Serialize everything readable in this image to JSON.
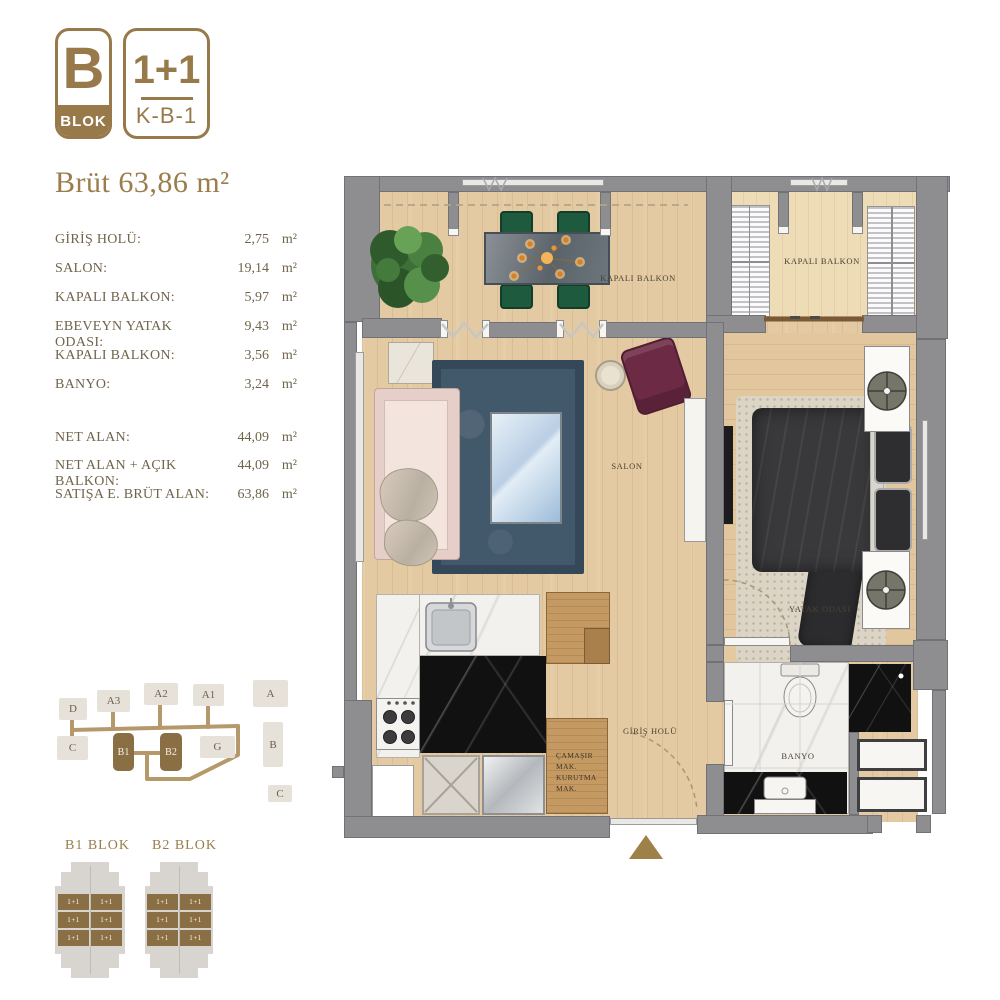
{
  "header": {
    "block_letter": "B",
    "block_word": "BLOK",
    "unit_type": "1+1",
    "unit_code": "K-B-1",
    "title": "Brüt 63,86 m²"
  },
  "area_table": {
    "rows": [
      {
        "label": "GİRİŞ HOLÜ:",
        "value": "2,75",
        "unit": "m²"
      },
      {
        "label": "SALON:",
        "value": "19,14",
        "unit": "m²"
      },
      {
        "label": "KAPALI BALKON:",
        "value": "5,97",
        "unit": "m²"
      },
      {
        "label": "EBEVEYN YATAK ODASI:",
        "value": "9,43",
        "unit": "m²"
      },
      {
        "label": "KAPALI BALKON:",
        "value": "3,56",
        "unit": "m²"
      },
      {
        "label": "BANYO:",
        "value": "3,24",
        "unit": "m²"
      }
    ],
    "totals": [
      {
        "label": "NET ALAN:",
        "value": "44,09",
        "unit": "m²"
      },
      {
        "label": "NET ALAN + AÇIK BALKON:",
        "value": "44,09",
        "unit": "m²"
      },
      {
        "label": "SATIŞA E. BRÜT ALAN:",
        "value": "63,86",
        "unit": "m²"
      }
    ]
  },
  "site_plan": {
    "blocks": [
      {
        "label": "D",
        "highlighted": false
      },
      {
        "label": "A3",
        "highlighted": false
      },
      {
        "label": "A2",
        "highlighted": false
      },
      {
        "label": "A1",
        "highlighted": false
      },
      {
        "label": "A",
        "highlighted": false
      },
      {
        "label": "C",
        "highlighted": false
      },
      {
        "label": "B1",
        "highlighted": true
      },
      {
        "label": "B2",
        "highlighted": true
      },
      {
        "label": "G",
        "highlighted": false
      },
      {
        "label": "B",
        "highlighted": false
      },
      {
        "label": "C",
        "highlighted": false
      }
    ]
  },
  "mini_blocks": [
    {
      "title": "B1 BLOK",
      "unit_labels": [
        "1+1",
        "1+1",
        "1+1",
        "1+1",
        "1+1",
        "1+1"
      ]
    },
    {
      "title": "B2 BLOK",
      "unit_labels": [
        "1+1",
        "1+1",
        "1+1",
        "1+1",
        "1+1",
        "1+1"
      ]
    }
  ],
  "floor_plan": {
    "labels": {
      "balcony_left": "KAPALI BALKON",
      "balcony_right": "KAPALI BALKON",
      "salon": "SALON",
      "bedroom": "YATAK ODASI",
      "hall": "GİRİŞ HOLÜ",
      "bathroom": "BANYO",
      "laundry_lines": [
        "ÇAMAŞIR",
        "MAK.",
        "KURUTMA",
        "MAK."
      ]
    }
  },
  "colors": {
    "gold": "#97794a",
    "wall_gray": "#8e8e91",
    "wood": "#e4caa2",
    "rug_navy": "#42586b",
    "highlight_block": "#8a6f45"
  }
}
